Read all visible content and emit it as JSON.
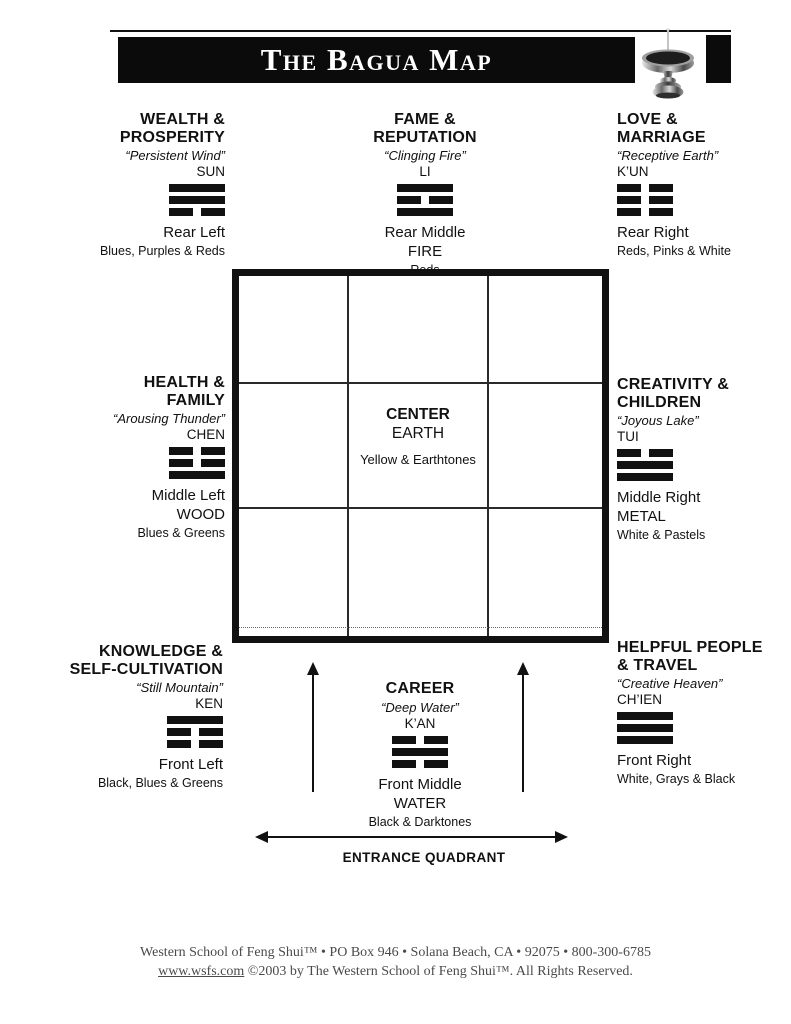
{
  "colors": {
    "ink": "#111111",
    "banner_bg": "#0b0b0b",
    "footer_text": "#4a4a4a"
  },
  "header": {
    "title": "The Bagua Map"
  },
  "sections": {
    "wealth": {
      "title": "WEALTH &\nPROSPERITY",
      "quote": "“Persistent Wind”",
      "trigram_name": "SUN",
      "trigram": [
        "solid",
        "solid",
        "broken"
      ],
      "position": "Rear Left",
      "colors": "Blues, Purples & Reds"
    },
    "fame": {
      "title": "FAME &\nREPUTATION",
      "quote": "“Clinging Fire”",
      "trigram_name": "LI",
      "trigram": [
        "solid",
        "broken",
        "solid"
      ],
      "position": "Rear Middle",
      "element": "FIRE",
      "colors": "Reds"
    },
    "love": {
      "title": "LOVE &\nMARRIAGE",
      "quote": "“Receptive Earth”",
      "trigram_name": "K’UN",
      "trigram": [
        "broken",
        "broken",
        "broken"
      ],
      "position": "Rear Right",
      "colors": "Reds, Pinks & White"
    },
    "health": {
      "title": "HEALTH &\nFAMILY",
      "quote": "“Arousing Thunder”",
      "trigram_name": "CHEN",
      "trigram": [
        "broken",
        "broken",
        "solid"
      ],
      "position": "Middle Left",
      "element": "WOOD",
      "colors": "Blues & Greens"
    },
    "creativity": {
      "title": "CREATIVITY &\nCHILDREN",
      "quote": "“Joyous Lake”",
      "trigram_name": "TUI",
      "trigram": [
        "broken",
        "solid",
        "solid"
      ],
      "position": "Middle Right",
      "element": "METAL",
      "colors": "White & Pastels"
    },
    "knowledge": {
      "title": "KNOWLEDGE &\nSELF-CULTIVATION",
      "quote": "“Still Mountain”",
      "trigram_name": "KEN",
      "trigram": [
        "solid",
        "broken",
        "broken"
      ],
      "position": "Front Left",
      "colors": "Black, Blues & Greens"
    },
    "career": {
      "title": "CAREER",
      "quote": "“Deep Water”",
      "trigram_name": "K’AN",
      "trigram": [
        "broken",
        "solid",
        "broken"
      ],
      "position": "Front Middle",
      "element": "WATER",
      "colors": "Black & Darktones"
    },
    "helpful": {
      "title": "HELPFUL PEOPLE\n& TRAVEL",
      "quote": "“Creative Heaven”",
      "trigram_name": "CH’IEN",
      "trigram": [
        "solid",
        "solid",
        "solid"
      ],
      "position": "Front Right",
      "colors": "White, Grays & Black"
    }
  },
  "center": {
    "title": "CENTER",
    "element": "EARTH",
    "colors": "Yellow & Earthtones"
  },
  "entrance": {
    "label": "ENTRANCE QUADRANT"
  },
  "footer": {
    "line1": "Western School of Feng Shui™ • PO Box 946 • Solana Beach, CA • 92075 • 800-300-6785",
    "link": "www.wsfs.com",
    "line2": "©2003 by The Western School of Feng Shui™. All Rights Reserved."
  }
}
